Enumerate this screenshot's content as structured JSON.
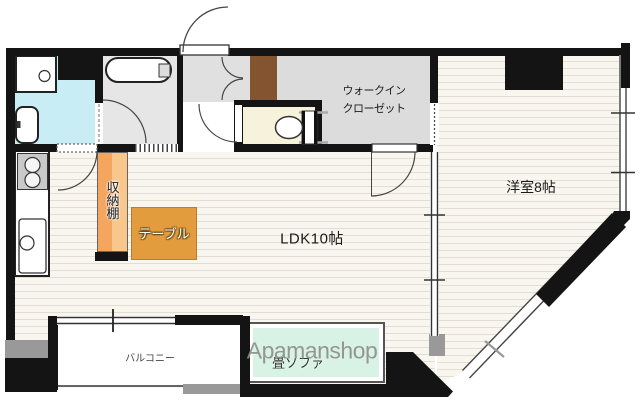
{
  "watermark": {
    "text": "Apamanshop",
    "color": "#8f8f8f"
  },
  "rooms": {
    "ldk": {
      "label": "LDK10帖"
    },
    "western_room": {
      "label": "洋室8帖"
    },
    "walk_in_closet": {
      "line1": "ウォークイン",
      "line2": "クローゼット"
    },
    "balcony": {
      "label": "バルコニー"
    }
  },
  "furniture": {
    "storage_shelf": {
      "label": "収納棚",
      "color": "#f4a55e"
    },
    "table": {
      "label": "テーブル",
      "color": "#e29c3e"
    },
    "tatami_sofa": {
      "label": "畳ソファ",
      "color": "#d8f3e5"
    }
  },
  "colors": {
    "wall": "#141414",
    "flooring": "#f8f6ef",
    "flooring_stripe": "#e2ded4",
    "washroom": "#c9edf4",
    "bathroom": "#e6e6e6",
    "hallway": "#e0e0e0",
    "closet": "#dcdcdc",
    "toilet_room": "#f6f2dc",
    "entrance_cabinet": "#845430"
  }
}
